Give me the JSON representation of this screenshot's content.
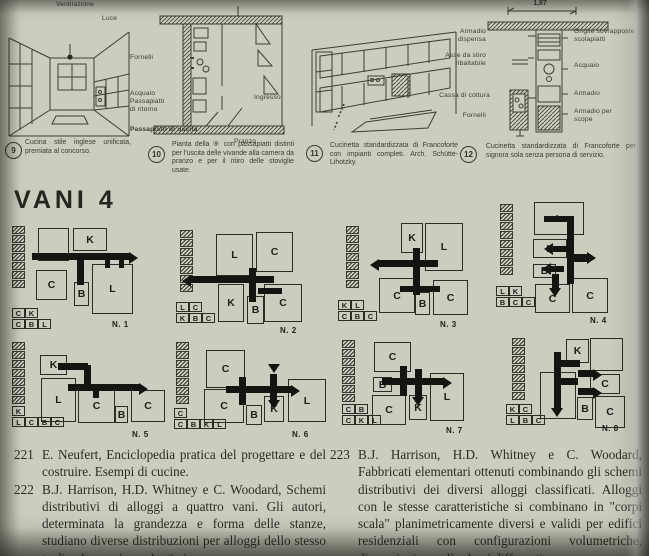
{
  "page": {
    "bg": "#cbcdbf",
    "ink": "#32322a",
    "bar_color": "#141410"
  },
  "figures": [
    {
      "num": "9",
      "labels": {
        "ventilazione": "Ventilazione",
        "luce": "Luce"
      },
      "caption": "Cucina stile inglese unificata, premiata al concorso."
    },
    {
      "num": "10",
      "labels": {
        "fornelli": "Fornelli",
        "acquaio": "Acquaio",
        "passapiatti": "Passapiatti",
        "ritorno": "di ritorno",
        "uscita": "Passapiatti di uscita",
        "ingresso": "Ingresso",
        "pranzo": "Pranzo"
      },
      "caption": "Pianta della ⑨ con passapiatti distinti per l'uscita delle vivande alla camera da pranzo e per il ritiro delle stoviglie usate."
    },
    {
      "num": "11",
      "caption": "Cucinetta standardizzata di Francoforte con impianti completi. Arch. Schütte-Lihotzky."
    },
    {
      "num": "12",
      "dimension": "1,87",
      "labels": {
        "armadio_dispensa": "Armadio dispensa",
        "asse": "Asse da stiro ribaltabile",
        "cassa": "Cassa di cottura",
        "fornelli": "Fornelli",
        "griglie": "Griglie sovrapposte scolapiatti",
        "acquaio": "Acquaio",
        "armadio": "Armadio",
        "scope": "Armadio per scope"
      },
      "caption": "Cucinetta standardizzata di Francoforte per signora sola senza persona di servizio."
    }
  ],
  "vani": {
    "heading": "VANI 4",
    "room_letters_meaning": [
      "K",
      "C",
      "B",
      "L"
    ],
    "schemes": [
      {
        "name": "N. 1",
        "x": 8,
        "y": 222,
        "strip": {
          "x": 4,
          "y": 4,
          "count": 7
        },
        "legend": {
          "x": 4,
          "y": 86,
          "rows": [
            [
              "C",
              "K"
            ],
            [
              "C",
              "B",
              "L"
            ]
          ]
        },
        "rooms": [
          {
            "x": 30,
            "y": 6,
            "w": 31,
            "h": 33,
            "label": ""
          },
          {
            "x": 65,
            "y": 6,
            "w": 34,
            "h": 23,
            "label": "K"
          },
          {
            "x": 28,
            "y": 48,
            "w": 31,
            "h": 30,
            "label": "C"
          },
          {
            "x": 66,
            "y": 60,
            "w": 15,
            "h": 24,
            "label": "B"
          },
          {
            "x": 84,
            "y": 42,
            "w": 41,
            "h": 50,
            "label": "L"
          }
        ],
        "bars": [
          {
            "x": 24,
            "y": 31,
            "w": 98,
            "h": 7
          },
          {
            "x": 69,
            "y": 31,
            "w": 7,
            "h": 32
          },
          {
            "x": 97,
            "y": 34,
            "w": 5,
            "h": 12
          },
          {
            "x": 111,
            "y": 34,
            "w": 5,
            "h": 12
          }
        ],
        "arrows": [
          {
            "x": 121,
            "y": 30,
            "dir": "right"
          }
        ],
        "nx": 104,
        "ny": 98
      },
      {
        "name": "N. 2",
        "x": 168,
        "y": 222,
        "strip": {
          "x": 12,
          "y": 8,
          "count": 7
        },
        "legend": {
          "x": 8,
          "y": 80,
          "rows": [
            [
              "L",
              "C"
            ],
            [
              "K",
              "B",
              "C"
            ]
          ]
        },
        "rooms": [
          {
            "x": 48,
            "y": 12,
            "w": 37,
            "h": 42,
            "label": "L"
          },
          {
            "x": 88,
            "y": 10,
            "w": 37,
            "h": 40,
            "label": "C"
          },
          {
            "x": 96,
            "y": 62,
            "w": 38,
            "h": 38,
            "label": "C"
          },
          {
            "x": 50,
            "y": 62,
            "w": 26,
            "h": 38,
            "label": "K"
          },
          {
            "x": 79,
            "y": 74,
            "w": 17,
            "h": 28,
            "label": "B"
          }
        ],
        "bars": [
          {
            "x": 22,
            "y": 54,
            "w": 84,
            "h": 7
          },
          {
            "x": 90,
            "y": 66,
            "w": 24,
            "h": 6
          },
          {
            "x": 81,
            "y": 46,
            "w": 7,
            "h": 34
          }
        ],
        "arrows": [
          {
            "x": 14,
            "y": 53,
            "dir": "left"
          }
        ],
        "nx": 112,
        "ny": 104
      },
      {
        "name": "N. 3",
        "x": 330,
        "y": 220,
        "strip": {
          "x": 16,
          "y": 6,
          "count": 7
        },
        "legend": {
          "x": 8,
          "y": 80,
          "rows": [
            [
              "K",
              "L"
            ],
            [
              "C",
              "B",
              "C"
            ]
          ]
        },
        "rooms": [
          {
            "x": 71,
            "y": 3,
            "w": 22,
            "h": 30,
            "label": "K"
          },
          {
            "x": 95,
            "y": 3,
            "w": 38,
            "h": 48,
            "label": "L"
          },
          {
            "x": 49,
            "y": 58,
            "w": 36,
            "h": 35,
            "label": "C"
          },
          {
            "x": 103,
            "y": 60,
            "w": 35,
            "h": 35,
            "label": "C"
          },
          {
            "x": 85,
            "y": 72,
            "w": 15,
            "h": 23,
            "label": "B"
          }
        ],
        "bars": [
          {
            "x": 48,
            "y": 40,
            "w": 60,
            "h": 7
          },
          {
            "x": 83,
            "y": 28,
            "w": 7,
            "h": 47
          },
          {
            "x": 70,
            "y": 66,
            "w": 40,
            "h": 6
          }
        ],
        "arrows": [
          {
            "x": 40,
            "y": 39,
            "dir": "left"
          }
        ],
        "nx": 110,
        "ny": 100
      },
      {
        "name": "N. 4",
        "x": 492,
        "y": 202,
        "strip": {
          "x": 8,
          "y": 2,
          "count": 8
        },
        "legend": {
          "x": 4,
          "y": 84,
          "rows": [
            [
              "L",
              "K"
            ],
            [
              "B",
              "C",
              "C"
            ]
          ]
        },
        "rooms": [
          {
            "x": 42,
            "y": 0,
            "w": 50,
            "h": 33,
            "label": "L"
          },
          {
            "x": 41,
            "y": 37,
            "w": 34,
            "h": 19,
            "label": "K"
          },
          {
            "x": 41,
            "y": 62,
            "w": 23,
            "h": 14,
            "label": "B"
          },
          {
            "x": 43,
            "y": 82,
            "w": 35,
            "h": 29,
            "label": "C"
          },
          {
            "x": 80,
            "y": 76,
            "w": 36,
            "h": 35,
            "label": "C"
          }
        ],
        "bars": [
          {
            "x": 75,
            "y": 20,
            "w": 7,
            "h": 62
          },
          {
            "x": 82,
            "y": 52,
            "w": 14,
            "h": 8
          },
          {
            "x": 60,
            "y": 44,
            "w": 16,
            "h": 6
          },
          {
            "x": 58,
            "y": 64,
            "w": 14,
            "h": 6
          },
          {
            "x": 60,
            "y": 72,
            "w": 7,
            "h": 14
          },
          {
            "x": 52,
            "y": 14,
            "w": 30,
            "h": 6
          }
        ],
        "arrows": [
          {
            "x": 52,
            "y": 41,
            "dir": "left"
          },
          {
            "x": 50,
            "y": 61,
            "dir": "left"
          },
          {
            "x": 57,
            "y": 86,
            "dir": "down"
          },
          {
            "x": 95,
            "y": 50,
            "dir": "right"
          }
        ],
        "nx": 98,
        "ny": 114
      },
      {
        "name": "N. 5",
        "x": 8,
        "y": 338,
        "strip": {
          "x": 4,
          "y": 4,
          "count": 7
        },
        "legend": {
          "x": 4,
          "y": 68,
          "rows": [
            [
              "K"
            ],
            [
              "L",
              "C",
              "B",
              "C"
            ]
          ]
        },
        "rooms": [
          {
            "x": 32,
            "y": 17,
            "w": 27,
            "h": 20,
            "label": "K"
          },
          {
            "x": 33,
            "y": 40,
            "w": 35,
            "h": 44,
            "label": "L"
          },
          {
            "x": 70,
            "y": 51,
            "w": 37,
            "h": 34,
            "label": "C"
          },
          {
            "x": 107,
            "y": 68,
            "w": 13,
            "h": 17,
            "label": "B"
          },
          {
            "x": 123,
            "y": 52,
            "w": 34,
            "h": 32,
            "label": "C"
          }
        ],
        "bars": [
          {
            "x": 50,
            "y": 25,
            "w": 30,
            "h": 7
          },
          {
            "x": 76,
            "y": 27,
            "w": 7,
            "h": 20
          },
          {
            "x": 60,
            "y": 46,
            "w": 72,
            "h": 7
          },
          {
            "x": 85,
            "y": 50,
            "w": 6,
            "h": 10
          }
        ],
        "arrows": [
          {
            "x": 131,
            "y": 45,
            "dir": "right"
          }
        ],
        "nx": 124,
        "ny": 92
      },
      {
        "name": "N. 6",
        "x": 170,
        "y": 338,
        "strip": {
          "x": 6,
          "y": 4,
          "count": 7
        },
        "legend": {
          "x": 4,
          "y": 70,
          "rows": [
            [
              "C"
            ],
            [
              "C",
              "B",
              "K",
              "L"
            ]
          ]
        },
        "rooms": [
          {
            "x": 36,
            "y": 12,
            "w": 39,
            "h": 38,
            "label": "C"
          },
          {
            "x": 34,
            "y": 51,
            "w": 40,
            "h": 34,
            "label": "C"
          },
          {
            "x": 76,
            "y": 67,
            "w": 16,
            "h": 20,
            "label": "B"
          },
          {
            "x": 94,
            "y": 58,
            "w": 20,
            "h": 26,
            "label": "K"
          },
          {
            "x": 118,
            "y": 41,
            "w": 38,
            "h": 43,
            "label": "L"
          }
        ],
        "bars": [
          {
            "x": 56,
            "y": 48,
            "w": 66,
            "h": 7
          },
          {
            "x": 69,
            "y": 39,
            "w": 7,
            "h": 28
          },
          {
            "x": 100,
            "y": 36,
            "w": 7,
            "h": 26
          }
        ],
        "arrows": [
          {
            "x": 121,
            "y": 47,
            "dir": "right"
          },
          {
            "x": 98,
            "y": 62,
            "dir": "down"
          },
          {
            "x": 98,
            "y": 26,
            "dir": "down"
          }
        ],
        "nx": 122,
        "ny": 92
      },
      {
        "name": "N. 7",
        "x": 330,
        "y": 336,
        "strip": {
          "x": 12,
          "y": 4,
          "count": 7
        },
        "legend": {
          "x": 12,
          "y": 68,
          "rows": [
            [
              "C",
              "B"
            ],
            [
              "C",
              "K",
              "L"
            ]
          ]
        },
        "rooms": [
          {
            "x": 44,
            "y": 6,
            "w": 37,
            "h": 30,
            "label": "C"
          },
          {
            "x": 43,
            "y": 41,
            "w": 19,
            "h": 15,
            "label": "B"
          },
          {
            "x": 100,
            "y": 37,
            "w": 34,
            "h": 48,
            "label": "L"
          },
          {
            "x": 42,
            "y": 59,
            "w": 34,
            "h": 30,
            "label": "C"
          },
          {
            "x": 79,
            "y": 59,
            "w": 18,
            "h": 25,
            "label": "K"
          }
        ],
        "bars": [
          {
            "x": 52,
            "y": 42,
            "w": 62,
            "h": 7
          },
          {
            "x": 70,
            "y": 30,
            "w": 7,
            "h": 30
          },
          {
            "x": 85,
            "y": 33,
            "w": 7,
            "h": 28
          }
        ],
        "arrows": [
          {
            "x": 113,
            "y": 41,
            "dir": "right"
          },
          {
            "x": 82,
            "y": 61,
            "dir": "down"
          }
        ],
        "nx": 116,
        "ny": 90
      },
      {
        "name": "N. 8",
        "x": 492,
        "y": 336,
        "strip": {
          "x": 20,
          "y": 2,
          "count": 7
        },
        "legend": {
          "x": 14,
          "y": 68,
          "rows": [
            [
              "K",
              "C"
            ],
            [
              "L",
              "B",
              "C"
            ]
          ]
        },
        "rooms": [
          {
            "x": 74,
            "y": 3,
            "w": 23,
            "h": 24,
            "label": "K"
          },
          {
            "x": 98,
            "y": 2,
            "w": 33,
            "h": 33,
            "label": ""
          },
          {
            "x": 98,
            "y": 38,
            "w": 30,
            "h": 20,
            "label": "C"
          },
          {
            "x": 103,
            "y": 60,
            "w": 30,
            "h": 32,
            "label": "C"
          },
          {
            "x": 48,
            "y": 36,
            "w": 36,
            "h": 47,
            "label": "L"
          },
          {
            "x": 85,
            "y": 61,
            "w": 16,
            "h": 23,
            "label": "B"
          }
        ],
        "bars": [
          {
            "x": 62,
            "y": 16,
            "w": 7,
            "h": 56
          },
          {
            "x": 62,
            "y": 24,
            "w": 26,
            "h": 7
          },
          {
            "x": 62,
            "y": 42,
            "w": 24,
            "h": 7
          },
          {
            "x": 86,
            "y": 34,
            "w": 16,
            "h": 7
          },
          {
            "x": 86,
            "y": 52,
            "w": 16,
            "h": 7
          }
        ],
        "arrows": [
          {
            "x": 101,
            "y": 33,
            "dir": "right"
          },
          {
            "x": 101,
            "y": 51,
            "dir": "right"
          },
          {
            "x": 59,
            "y": 72,
            "dir": "down"
          }
        ],
        "nx": 110,
        "ny": 88
      }
    ]
  },
  "bibliography": {
    "left": [
      {
        "num": "221",
        "text": "E. Neufert, Enciclopedia pratica del progettare e del costruire. Esempi di cucine."
      },
      {
        "num": "222",
        "text": "B.J. Harrison, H.D. Whitney e C. Woodard, Schemi distributivi di alloggi a quattro vani. Gli autori, determinata la grandezza e forma delle stanze, studiano diverse distribuzioni per alloggi dello stesso taglio che, se rispondenti ai"
      }
    ],
    "right": [
      {
        "num": "223",
        "text": "B.J. Harrison, H.D. Whitney e C. Woodard, Fabbricati elementari ottenuti combinando gli schemi distributivi dei diversi alloggi classificati. Alloggi con le stesse caratteristiche si combinano in \"corpi scala\" planimetricamente diversi e validi per edifici residenziali con configurazioni volumetriche, dimensioni e ruoli urbani differenti."
      }
    ]
  }
}
